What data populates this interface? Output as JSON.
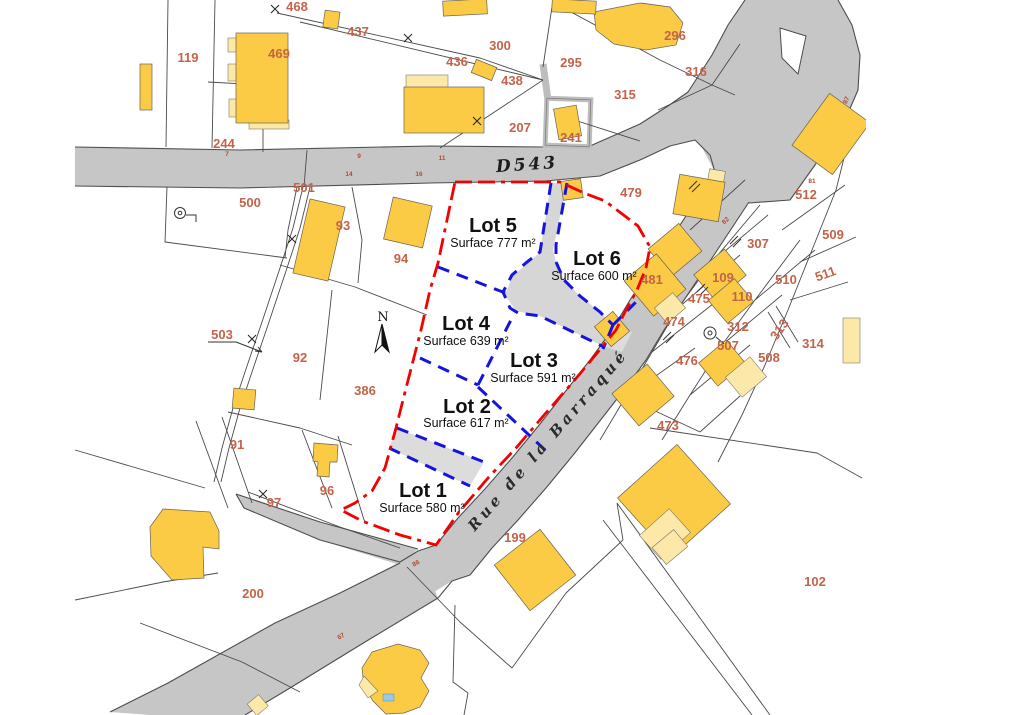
{
  "map": {
    "type": "cadastral-allotment-plan",
    "road_labels": [
      {
        "text": "D543"
      },
      {
        "text": "Rue de la Barraqué"
      }
    ],
    "north_label": "N",
    "lots": [
      {
        "name": "Lot 1",
        "surface": "Surface 580 m²"
      },
      {
        "name": "Lot 2",
        "surface": "Surface 617 m²"
      },
      {
        "name": "Lot 3",
        "surface": "Surface 591 m²"
      },
      {
        "name": "Lot 4",
        "surface": "Surface 639 m²"
      },
      {
        "name": "Lot 5",
        "surface": "Surface 777 m²"
      },
      {
        "name": "Lot 6",
        "surface": "Surface 600 m²"
      }
    ],
    "parcels": [
      "468",
      "437",
      "119",
      "469",
      "436",
      "300",
      "295",
      "296",
      "316",
      "315",
      "438",
      "207",
      "241",
      "244",
      "501",
      "500",
      "93",
      "94",
      "479",
      "512",
      "509",
      "307",
      "481",
      "109",
      "110",
      "510",
      "511",
      "475",
      "474",
      "312",
      "313",
      "314",
      "503",
      "92",
      "386",
      "507",
      "508",
      "476",
      "91",
      "473",
      "97",
      "96",
      "199",
      "200",
      "102"
    ],
    "road_numbers": [
      "7",
      "9",
      "11",
      "14",
      "16",
      "87",
      "81",
      "82",
      "86",
      "67"
    ],
    "colors": {
      "building": "#fbcb45",
      "building_light": "#fce8a8",
      "road": "#c6c6c6",
      "driveway": "#d6d6d6",
      "boundary_red": "#f40000",
      "divider_blue": "#1414e0",
      "parcel_number": "#c4634a"
    }
  }
}
